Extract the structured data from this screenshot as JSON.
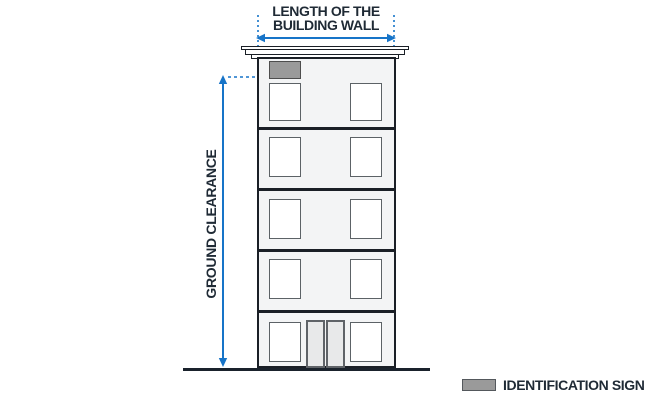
{
  "labels": {
    "length_line1": "LENGTH OF THE",
    "length_line2": "BUILDING WALL",
    "ground_clearance": "GROUND CLEARANCE",
    "identification_sign": "IDENTIFICATION SIGN"
  },
  "building": {
    "floors": 5,
    "windows_per_floor": 2,
    "entrance": "double door on ground floor",
    "identification_sign_position": "top-left wall, below cornice"
  },
  "colors": {
    "accent_blue": "#1774C8",
    "label_text": "#1F2A35",
    "sign_fill": "#9A9A9A",
    "sign_border": "#4D4D4D",
    "outline_dark": "#1A1F26",
    "wall_fill": "#F3F4F5"
  }
}
